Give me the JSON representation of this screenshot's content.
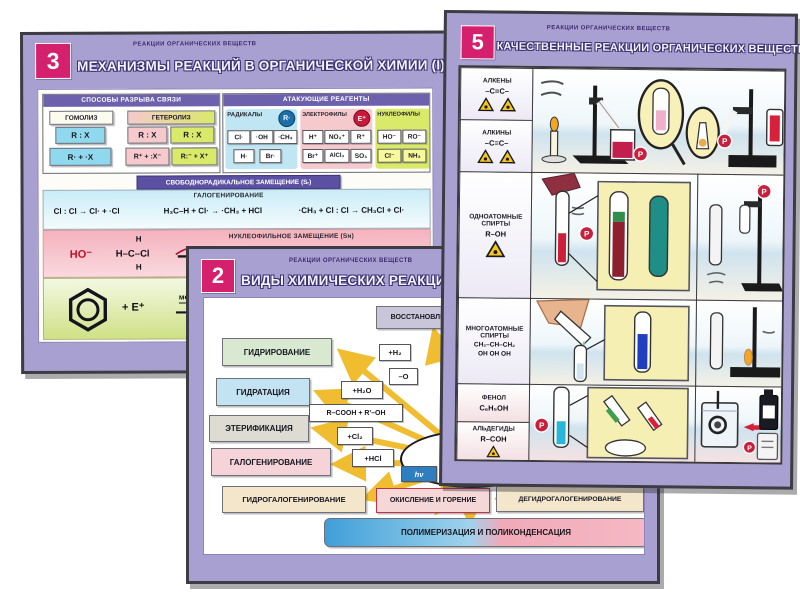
{
  "colors": {
    "badge_pink": "#d4206d",
    "mat_purple": "#a9a0d2",
    "frame_dark": "#3c3c42",
    "arrow_yellow": "#f0bd30",
    "hazard_yellow": "#f6c51f",
    "accent_blue_box": "#8fd8ee",
    "accent_pink_box": "#f6c9cc",
    "accent_green_box": "#d9e96a"
  },
  "p3": {
    "badge": "3",
    "series": "РЕАКЦИИ ОРГАНИЧЕСКИХ ВЕЩЕСТВ",
    "title": "МЕХАНИЗМЫ РЕАКЦИЙ В ОРГАНИЧЕСКОЙ ХИМИИ (I)",
    "bond": {
      "header": "СПОСОБЫ РАЗРЫВА СВЯЗИ",
      "homolysis": "ГОМОЛИЗ",
      "heterolysis": "ГЕТЕРОЛИЗ",
      "homo1": "R : X",
      "homo2": "R· + ·X",
      "het_p1": "R : X",
      "het_g1": "R : X",
      "het_p2": "R⁺ + :X⁻",
      "het_g2": "R:⁻ + X⁺"
    },
    "reagents": {
      "header": "АТАКУЮЩИЕ РЕАГЕНТЫ",
      "groups": [
        {
          "label": "РАДИКАЛЫ",
          "symbol": "R·",
          "items": [
            "Cl·",
            "·OH",
            "·CH₃",
            "H·",
            "Br·"
          ]
        },
        {
          "label": "ЭЛЕКТРОФИЛЫ",
          "symbol": "E⁺",
          "items": [
            "H⁺",
            "NO₂⁺",
            "R⁺",
            "Br⁺",
            "AlCl₃",
            "SO₃"
          ]
        },
        {
          "label": "НУКЛЕОФИЛЫ",
          "symbol": "Nu⁻",
          "items": [
            "HO⁻",
            "RO⁻",
            "Cl⁻",
            "NH₃"
          ]
        }
      ]
    },
    "banner": "СВОБОДНОРАДИКАЛЬНОЕ ЗАМЕЩЕНИЕ (Sᵣ)",
    "sr": {
      "label": "ГАЛОГЕНИРОВАНИЕ",
      "eq1": "Cl : Cl → Cl· + ·Cl",
      "eq2": "H₃C–H + Cl· → ·CH₃ + HCl",
      "eq3": "·CH₃ + Cl : Cl → CH₃Cl + Cl·"
    },
    "sn": {
      "label": "НУКЛЕОФИЛЬНОЕ ЗАМЕЩЕНИЕ (Sɴ)",
      "nu": "HO⁻",
      "h_top": "H",
      "mid": "H–C–Cl",
      "h_bot": "H"
    },
    "se": {
      "label": "ЭЛЕКТРОФИЛЬНОЕ ЗАМЕЩЕНИЕ (Sᴇ)",
      "plus": "+ E⁺",
      "slow": "медленно",
      "pi": "π-комплекс"
    }
  },
  "p2": {
    "badge": "2",
    "series": "РЕАКЦИИ ОРГАНИЧЕСКИХ ВЕЩЕСТВ",
    "title": "ВИДЫ ХИМИЧЕСКИХ РЕАКЦИЙ",
    "center": "РЕАКЦИИ",
    "boxes": {
      "reduction": "ВОССТАНОВЛЕНИЕ",
      "hydrogenation": "ГИДРИРОВАНИЕ",
      "hydration": "ГИДРАТАЦИЯ",
      "esterification": "ЭТЕРИФИКАЦИЯ",
      "halogenation": "ГАЛОГЕНИРОВАНИЕ",
      "hydrohalogenation": "ГИДРОГАЛОГЕНИРОВАНИЕ",
      "oxidation": "ОКИСЛЕНИЕ И ГОРЕНИЕ",
      "dehydrohalogenation": "ДЕГИДРОГАЛОГЕНИРОВАНИЕ",
      "polymerization": "ПОЛИМЕРИЗАЦИЯ И ПОЛИКОНДЕНСАЦИЯ"
    },
    "chips": {
      "h2": "+H₂",
      "minus_o": "–O",
      "h2o": "+H₂O",
      "acid": "R–COOH + R'–OH",
      "cl2": "+Cl₂",
      "hcl": "+HCl",
      "hv": "hν"
    }
  },
  "p5": {
    "badge": "5",
    "series": "РЕАКЦИИ ОРГАНИЧЕСКИХ ВЕЩЕСТВ",
    "title": "КАЧЕСТВЕННЫЕ РЕАКЦИИ ОРГАНИЧЕСКИХ ВЕЩЕСТВ (I)",
    "rows": {
      "alkenes": {
        "name": "АЛКЕНЫ",
        "formula": "–C=C–"
      },
      "alkynes": {
        "name": "АЛКИНЫ",
        "formula": "–C≡C–"
      },
      "alcohols": {
        "name": "ОДНОАТОМНЫЕ СПИРТЫ",
        "formula": "R–OH"
      },
      "polyols": {
        "name": "МНОГОАТОМНЫЕ СПИРТЫ",
        "formula": "CH₂–CH–CH₂",
        "formula2": "OH  OH  OH"
      },
      "phenol": {
        "name": "ФЕНОЛ",
        "formula": "C₆H₅OH"
      },
      "aldehydes": {
        "name": "АЛЬДЕГИДЫ",
        "formula": "R–COH"
      }
    },
    "badge_letter": "Р"
  }
}
